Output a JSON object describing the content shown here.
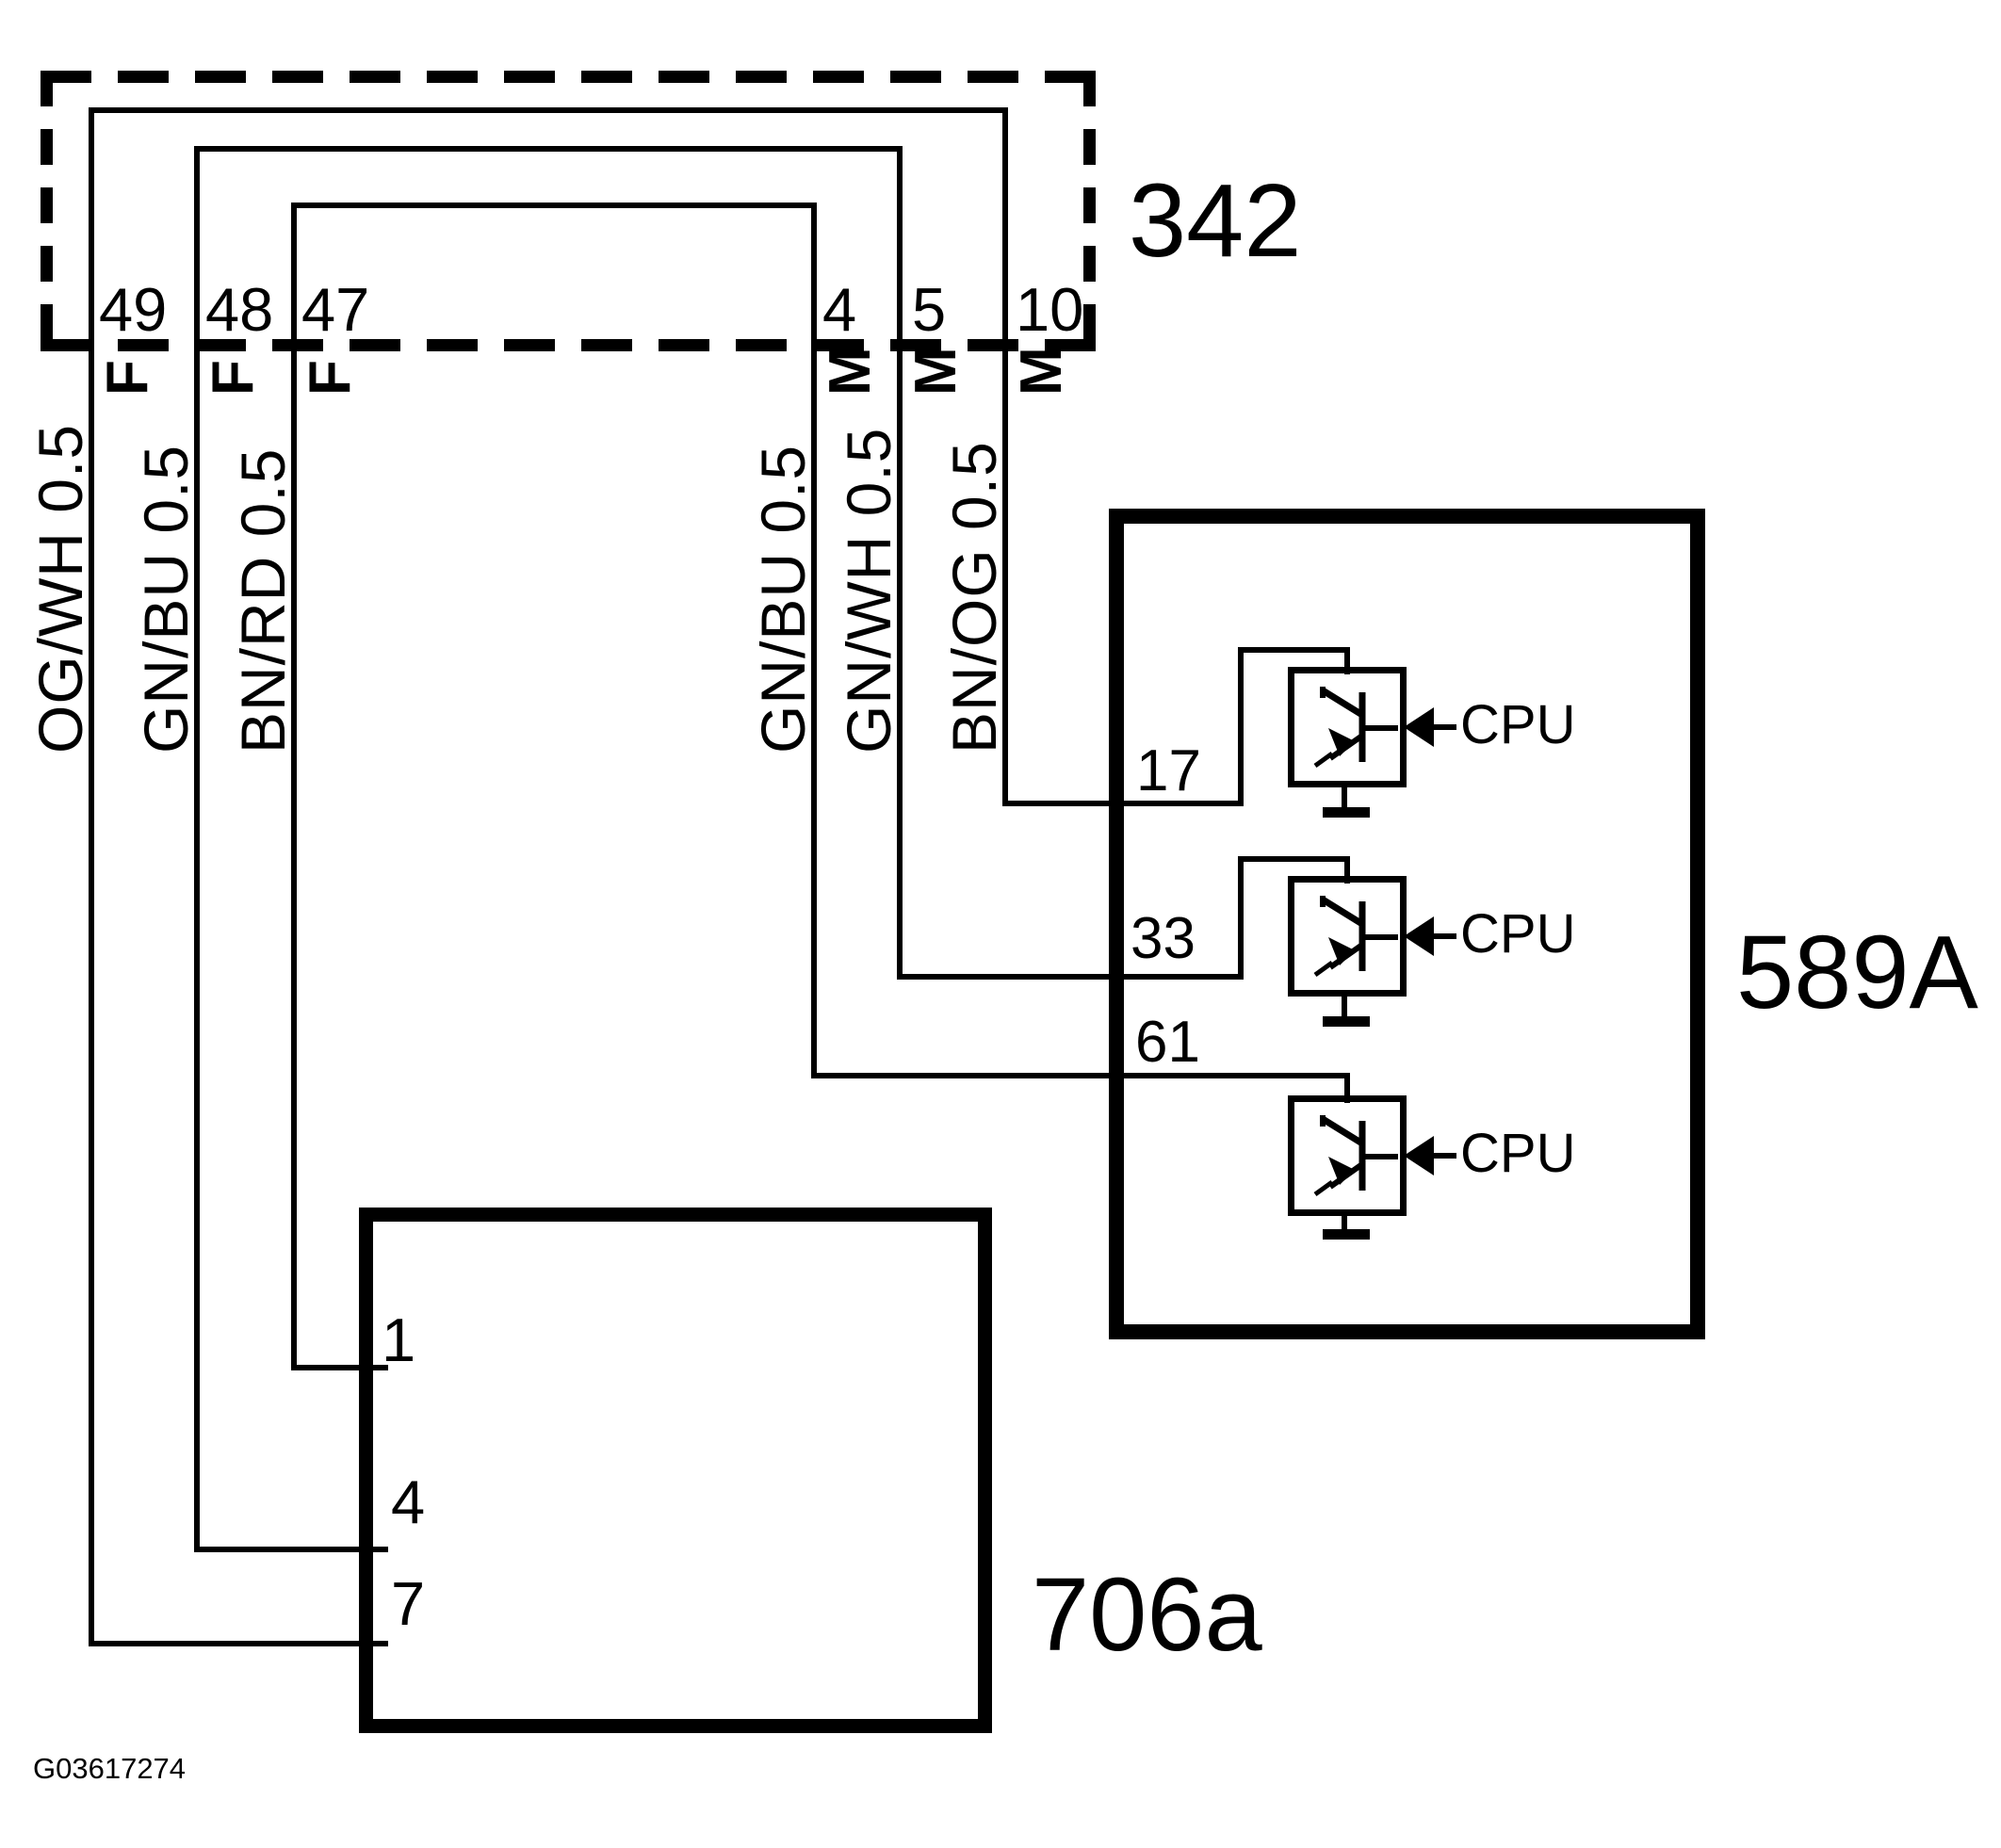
{
  "connector_342": {
    "id": "342",
    "left_pins": [
      {
        "num": "49",
        "gender": "F",
        "wire": "OG/WH 0.5"
      },
      {
        "num": "48",
        "gender": "F",
        "wire": "GN/BU 0.5"
      },
      {
        "num": "47",
        "gender": "F",
        "wire": "BN/RD 0.5"
      }
    ],
    "right_pins": [
      {
        "num": "4",
        "gender": "M",
        "wire": "GN/BU 0.5"
      },
      {
        "num": "5",
        "gender": "M",
        "wire": "GN/WH 0.5"
      },
      {
        "num": "10",
        "gender": "M",
        "wire": "BN/OG 0.5"
      }
    ]
  },
  "module_589a": {
    "id": "589A",
    "pins": [
      {
        "num": "17",
        "cpu_label": "CPU"
      },
      {
        "num": "33",
        "cpu_label": "CPU"
      },
      {
        "num": "61",
        "cpu_label": "CPU"
      }
    ]
  },
  "module_706a": {
    "id": "706a",
    "pins": [
      {
        "num": "1"
      },
      {
        "num": "4"
      },
      {
        "num": "7"
      }
    ]
  },
  "footer": {
    "figure_id": "G03617274"
  },
  "colors": {
    "line": "#000000",
    "background": "#ffffff"
  }
}
